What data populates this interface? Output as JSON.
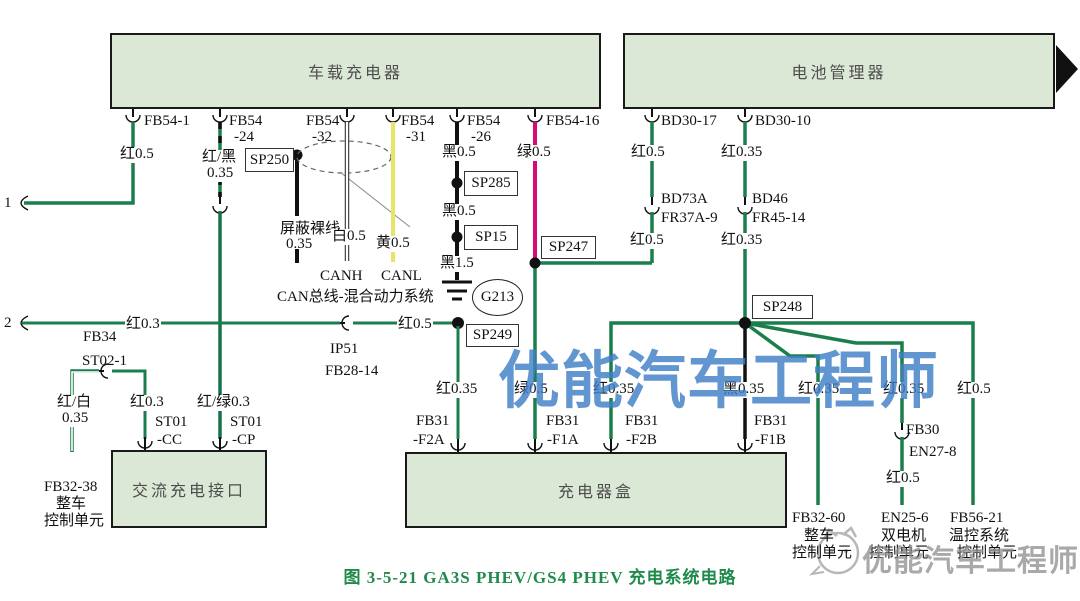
{
  "caption": "图 3-5-21  GA3S PHEV/GS4 PHEV 充电系统电路",
  "watermarks": {
    "main": "优能汽车工程师",
    "corner": "优能汽车工程师"
  },
  "colors": {
    "wire_red_drawn": "#1a7f4d",
    "wire_black": "#111111",
    "wire_green_drawn": "#d40b77",
    "wire_yellow": "#e8e468",
    "wire_white": "#ffffff",
    "box_fill": "#dce8d6",
    "box_border": "#1a1a1a",
    "caption_green": "#1f8a4c",
    "watermark_blue": "#3e7fc6"
  },
  "boxes": {
    "onboard_charger": "车载充电器",
    "battery_manager": "电池管理器",
    "ac_charge_port": "交流充电接口",
    "charger_box": "充电器盒"
  },
  "labels": {
    "fb54_1": "FB54-1",
    "fb54_24_a": "FB54",
    "fb54_24_b": "-24",
    "fb54_32_a": "FB54",
    "fb54_32_b": "-32",
    "fb54_31_a": "FB54",
    "fb54_31_b": "-31",
    "fb54_26_a": "FB54",
    "fb54_26_b": "-26",
    "fb54_16": "FB54-16",
    "bd30_17": "BD30-17",
    "bd30_10": "BD30-10",
    "red05_fb54_1": "红0.5",
    "redblack_a": "红/黑",
    "redblack_b": "0.35",
    "sp250": "SP250",
    "shield_a": "屏蔽裸线",
    "shield_b": "0.35",
    "white05": "白0.5",
    "yellow05": "黄0.5",
    "canh": "CANH",
    "canl": "CANL",
    "can_bus": "CAN总线-混合动力系统",
    "black05_a": "黑0.5",
    "sp285": "SP285",
    "black05_b": "黑0.5",
    "sp15": "SP15",
    "black15": "黑1.5",
    "g213": "G213",
    "green05_a": "绿0.5",
    "sp247": "SP247",
    "red05_bd_a": "红0.5",
    "bd73a": "BD73A",
    "fr37a_9": "FR37A-9",
    "red05_bd_b": "红0.5",
    "red035_bd_a": "红0.35",
    "bd46": "BD46",
    "fr45_14": "FR45-14",
    "red035_bd_b": "红0.35",
    "sp248": "SP248",
    "conn1": "1",
    "conn2": "2",
    "fb34": "FB34",
    "red03_a": "红0.3",
    "ip51": "IP51",
    "fb28_14": "FB28-14",
    "red05_mid": "红0.5",
    "sp249": "SP249",
    "st02_1": "ST02-1",
    "redwhite_a": "红/白",
    "redwhite_b": "0.35",
    "red03_b": "红0.3",
    "st01_cc_a": "ST01",
    "st01_cc_b": "-CC",
    "redgreen": "红/绿0.3",
    "st01_cp_a": "ST01",
    "st01_cp_b": "-CP",
    "fb32_38": "FB32-38",
    "vcu_a": "整车",
    "vcu_b": "控制单元",
    "red035_f2a": "红0.35",
    "fb31_f2a_a": "FB31",
    "fb31_f2a_b": "-F2A",
    "green05_b": "绿0.5",
    "fb31_f1a_a": "FB31",
    "fb31_f1a_b": "-F1A",
    "red035_f2b": "红0.35",
    "fb31_f2b_a": "FB31",
    "fb31_f2b_b": "-F2B",
    "black035": "黑0.35",
    "fb31_f1b_a": "FB31",
    "fb31_f1b_b": "-F1B",
    "red035_g1": "红0.35",
    "red035_g2": "红0.35",
    "red05_g3": "红0.5",
    "fb30": "FB30",
    "en27_8": "EN27-8",
    "red05_en": "红0.5",
    "fb32_60": "FB32-60",
    "m1_a": "整车",
    "m1_b": "控制单元",
    "en25_6": "EN25-6",
    "m2_a": "双电机",
    "m2_b": "控制单元",
    "fb56_21": "FB56-21",
    "m3_a": "温控系统",
    "m3_b": "控制单元"
  }
}
